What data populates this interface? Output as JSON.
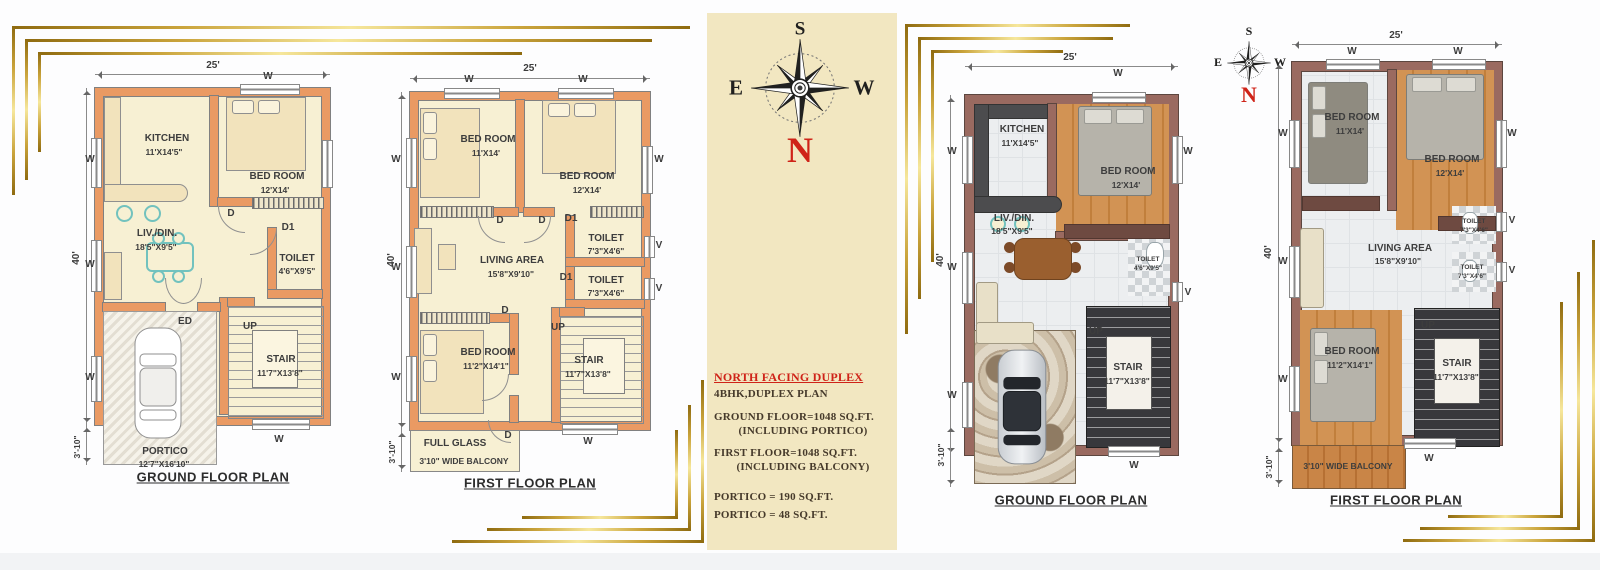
{
  "page": {
    "background": "#fdfdfe",
    "footer_strip": "#f2f3f5",
    "accent_gold": "#caa43c",
    "panel_bg": "#f2e7c1",
    "wall_orange": "#ea9a63",
    "wall_maroon": "#9a6a60",
    "accent_red": "#cf2318"
  },
  "compass": {
    "north": "N",
    "south": "S",
    "east": "E",
    "west": "W"
  },
  "marks": {
    "window": "W",
    "vent": "V",
    "door": "D",
    "door2": "D1",
    "entry": "ED",
    "up": "UP"
  },
  "dims": {
    "width": "25'",
    "height": "40'",
    "offset": "3'-10\""
  },
  "info": {
    "title": "NORTH FACING DUPLEX",
    "plan_type": "4BHK,DUPLEX PLAN",
    "ground_area": "GROUND FLOOR=1048 SQ.FT.",
    "ground_note": "(INCLUDING PORTICO)",
    "first_area": "FIRST FLOOR=1048 SQ.FT.",
    "first_note": "(INCLUDING BALCONY)",
    "portico_area": "PORTICO = 190 SQ.FT.",
    "portico_area2": "PORTICO = 48 SQ.FT."
  },
  "ground": {
    "title": "GROUND FLOOR PLAN",
    "kitchen": {
      "name": "KITCHEN",
      "size": "11'X14'5\""
    },
    "bedroom": {
      "name": "BED ROOM",
      "size": "12'X14'"
    },
    "livdin": {
      "name": "LIV./DIN.",
      "size": "18'5\"X9'5\""
    },
    "toilet": {
      "name": "TOILET",
      "size": "4'6\"X9'5\""
    },
    "stair": {
      "name": "STAIR",
      "size": "11'7\"X13'8\""
    },
    "portico": {
      "name": "PORTICO",
      "size": "12'7\"X16'10\""
    }
  },
  "first": {
    "title": "FIRST FLOOR PLAN",
    "bedroom1": {
      "name": "BED ROOM",
      "size": "11'X14'"
    },
    "bedroom2": {
      "name": "BED ROOM",
      "size": "12'X14'"
    },
    "living": {
      "name": "LIVING AREA",
      "size": "15'8\"X9'10\""
    },
    "toilet1": {
      "name": "TOILET",
      "size": "7'3\"X4'6\""
    },
    "toilet2": {
      "name": "TOILET",
      "size": "7'3\"X4'6\""
    },
    "bedroom3": {
      "name": "BED ROOM",
      "size": "11'2\"X14'1\""
    },
    "stair": {
      "name": "STAIR",
      "size": "11'7\"X13'8\""
    },
    "full_glass": "FULL GLASS",
    "balcony": "3'10\" WIDE BALCONY"
  }
}
